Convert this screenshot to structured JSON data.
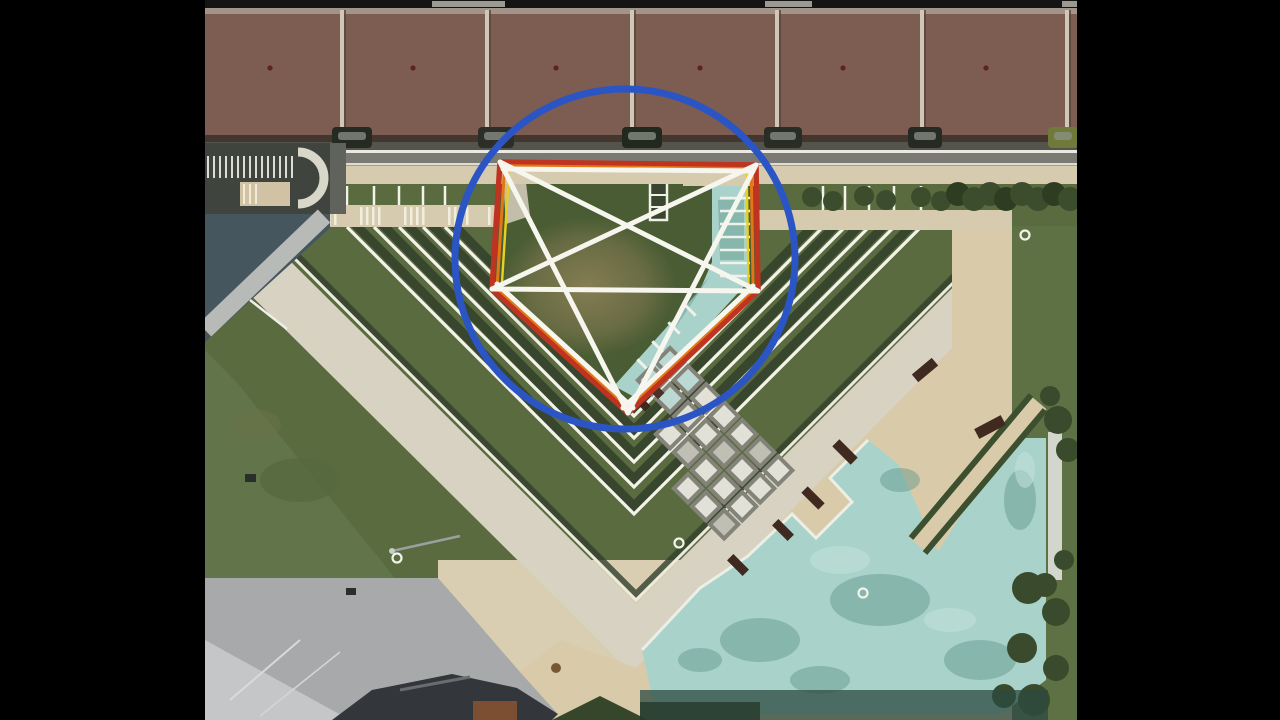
{
  "meta": {
    "description": "Letterboxed video frame: aerial satellite view of a terraced park plaza; geometric annotations (blue circle, red pentagon with orange and yellow inner outlines, white pentagram lines) are drawn over the central lawn.",
    "frame": {
      "width": 1280,
      "height": 720
    },
    "photo_area": {
      "x": 205,
      "y": 0,
      "width": 872,
      "height": 720
    }
  },
  "letterbox": {
    "color": "#000000",
    "left_width": 205,
    "right_width": 203
  },
  "annotations": {
    "circle": {
      "cx": 625,
      "cy": 259,
      "r": 170,
      "color": "#2b55c5",
      "stroke_width": 7
    },
    "pentagon": {
      "vertices": [
        [
          500,
          162
        ],
        [
          756,
          165
        ],
        [
          758,
          291
        ],
        [
          628,
          413
        ],
        [
          492,
          289
        ]
      ],
      "centroid": [
        626.8,
        264
      ],
      "outer_color": "#bf3420",
      "outer_width": 5.5,
      "mid_color": "#e07818",
      "mid_width": 3.2,
      "mid_scale": 0.963,
      "inner_color": "#e8d11e",
      "inner_width": 2.6,
      "inner_scale": 0.928
    },
    "white_lines": {
      "color": "#f6f6ee",
      "stroke_width": 5,
      "segments": [
        [
          503,
          169,
          753,
          171
        ],
        [
          500,
          162,
          758,
          291
        ],
        [
          500,
          162,
          628,
          413
        ],
        [
          756,
          165,
          492,
          289
        ],
        [
          756,
          165,
          628,
          413
        ],
        [
          492,
          289,
          758,
          291
        ],
        [
          497,
          284,
          633,
          408
        ],
        [
          753,
          286,
          623,
          408
        ]
      ]
    }
  },
  "scene": {
    "colors": {
      "grass": "#5a6b40",
      "grass_dark": "#31402a",
      "lawn": "#61744a",
      "lawn_right": "#5e7145",
      "roof": "#7d5c52",
      "roof_divider": "#cfc7b8",
      "roof_vent": "#5c2320",
      "road": "#7b7a72",
      "road_line": "#e9e9e1",
      "sidewalk": "#d6cbae",
      "walkway": "#d7d2c1",
      "asphalt": "#a7a9ab",
      "plaza": "#d9ceb2",
      "deck": "#d9cba9",
      "pool": "#a9d2cb",
      "pool_dark": "#5d948a",
      "pool_light": "#c2e2da",
      "hedge": "#3b4d2d",
      "tree": "#394b2c",
      "block": "#e2e1d7",
      "block_gap": "#83837a",
      "slate": "#46565f",
      "dark_roof": "#33363a",
      "rust_patch": "#7c4f33",
      "terrace_white": "#f3f3ea",
      "car_dark": "#262b22"
    },
    "roof": {
      "divider_xs": [
        340,
        485,
        630,
        775,
        920,
        1065
      ],
      "vent_xs": [
        270,
        413,
        556,
        700,
        843,
        986
      ],
      "vent_y": 68
    },
    "top_strip_segments": [
      [
        432,
        73
      ],
      [
        765,
        47
      ],
      [
        1062,
        15
      ]
    ],
    "cars": {
      "y": 127,
      "h": 21,
      "items": [
        {
          "x": 332,
          "w": 40,
          "color": "#262b22"
        },
        {
          "x": 478,
          "w": 36,
          "color": "#2e2e28"
        },
        {
          "x": 622,
          "w": 40,
          "color": "#23281f"
        },
        {
          "x": 764,
          "w": 38,
          "color": "#2a2d24"
        },
        {
          "x": 908,
          "w": 34,
          "color": "#262a22"
        },
        {
          "x": 1048,
          "w": 30,
          "color": "#6f7a3a"
        }
      ]
    },
    "terraces": {
      "center_x": 634,
      "top_y": 227,
      "tick_top_y": 186,
      "vertex_ys": [
        416,
        438,
        462,
        487,
        514
      ]
    },
    "crosswalk_stripe_group_xs": [
      316,
      360,
      404,
      448,
      488
    ],
    "hedge_clumps": [
      [
        812,
        197
      ],
      [
        833,
        201
      ],
      [
        864,
        196
      ],
      [
        886,
        200
      ],
      [
        921,
        197
      ],
      [
        941,
        201
      ]
    ],
    "hedge_row": {
      "x_start": 958,
      "x_end": 1072,
      "step": 16,
      "y": 196
    },
    "pool_tick_ys": [
      198,
      211,
      224,
      237,
      250,
      263,
      276
    ],
    "pool_diag_ticks": [
      [
        690,
        310
      ],
      [
        674,
        328
      ],
      [
        658,
        347
      ],
      [
        643,
        365
      ]
    ],
    "blocks": {
      "origin": [
        670,
        348
      ],
      "rotation": 45,
      "cell": 25.5,
      "size": 20,
      "row_cols": [
        2,
        2,
        3,
        3,
        4,
        4,
        4
      ]
    },
    "benches": [
      [
        845,
        452,
        26,
        10,
        45
      ],
      [
        813,
        498,
        24,
        9,
        45
      ],
      [
        783,
        530,
        22,
        9,
        45
      ],
      [
        990,
        427,
        30,
        11,
        -28
      ],
      [
        925,
        370,
        26,
        10,
        -40
      ],
      [
        738,
        565,
        22,
        9,
        45
      ]
    ],
    "trees": [
      [
        1028,
        588,
        16
      ],
      [
        1056,
        612,
        14
      ],
      [
        1022,
        648,
        15
      ],
      [
        1056,
        668,
        13
      ],
      [
        1034,
        700,
        16
      ],
      [
        1004,
        696,
        12
      ],
      [
        1064,
        560,
        10
      ],
      [
        1045,
        585,
        12
      ],
      [
        1058,
        420,
        14
      ],
      [
        1068,
        450,
        12
      ],
      [
        1050,
        396,
        10
      ]
    ],
    "pool_blobs_dark": [
      [
        760,
        640,
        40,
        22
      ],
      [
        880,
        600,
        50,
        26
      ],
      [
        980,
        660,
        36,
        20
      ],
      [
        1020,
        500,
        16,
        30
      ],
      [
        820,
        680,
        30,
        14
      ],
      [
        700,
        660,
        22,
        12
      ],
      [
        900,
        480,
        20,
        12
      ]
    ],
    "pool_blobs_light": [
      [
        840,
        560,
        30,
        14
      ],
      [
        950,
        620,
        26,
        12
      ],
      [
        1025,
        470,
        10,
        18
      ]
    ],
    "ground_markers": [
      [
        397,
        558
      ],
      [
        679,
        543
      ],
      [
        863,
        593
      ],
      [
        1025,
        235
      ]
    ]
  }
}
